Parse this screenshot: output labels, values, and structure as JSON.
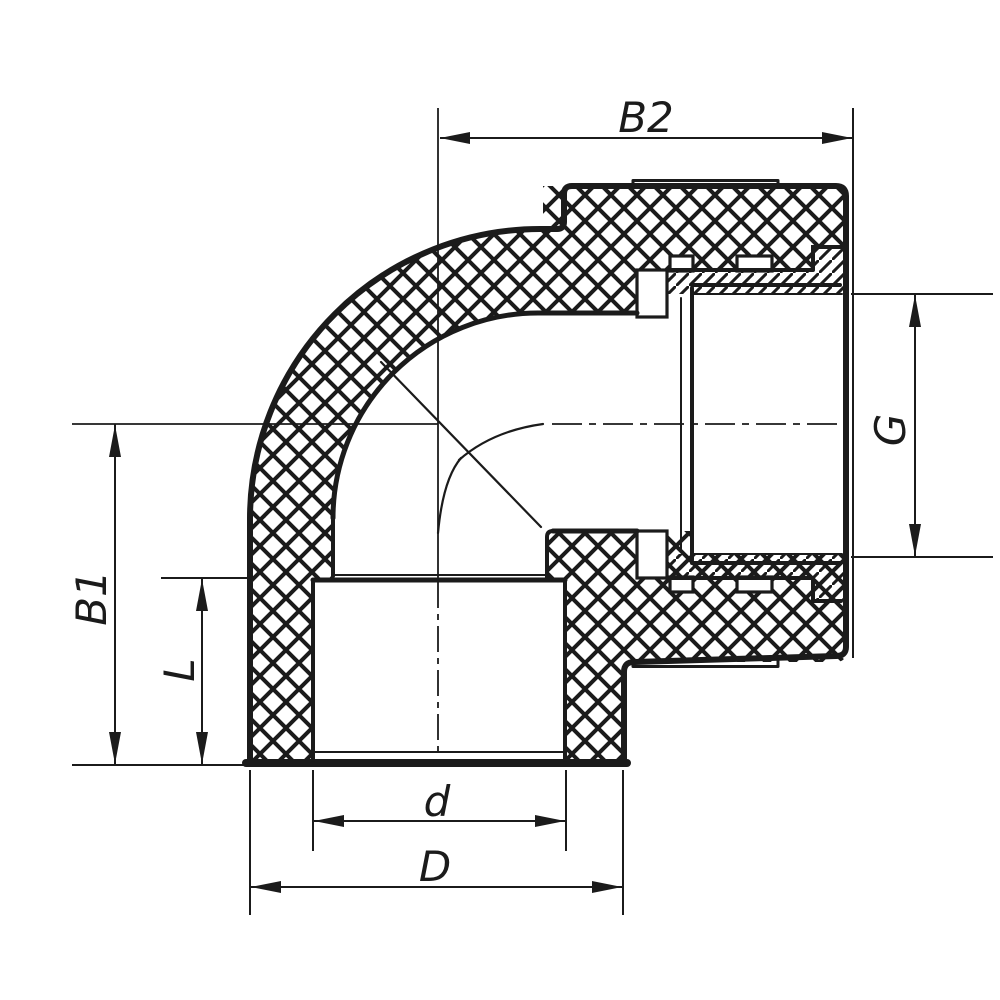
{
  "drawing": {
    "kind": "cross-section of 90-degree elbow pipe fitting (plastic body with threaded metal insert)",
    "colors": {
      "line": "#1b1b1b",
      "background": "#ffffff"
    },
    "labels": {
      "top_width": "B2",
      "thread_size": "G",
      "body_height": "B1",
      "socket_depth": "L",
      "inner_diameter": "d",
      "outer_diameter": "D"
    }
  }
}
